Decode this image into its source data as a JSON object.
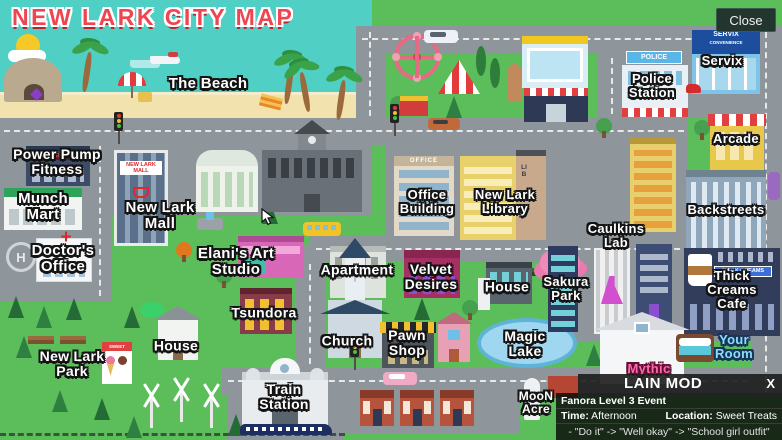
{
  "title": "NEW LARK CITY MAP",
  "close_button": "Close",
  "colors": {
    "water": "#50cfc5",
    "grass": "#5cbe5a",
    "road": "#8e959b",
    "sand": "#f2e2ad",
    "title_red": "#ef4550",
    "your_room_blue": "#8fdcf8",
    "mythic_pink": "#ff67b0",
    "panel_bg": "rgba(12,12,12,0.84)"
  },
  "locations": [
    {
      "id": "the-beach",
      "label": "The Beach"
    },
    {
      "id": "power-pump-fitness",
      "label": "Power Pump\nFitness"
    },
    {
      "id": "munch-mart",
      "label": "Munch\nMart"
    },
    {
      "id": "doctors-office",
      "label": "Doctor's\nOffice"
    },
    {
      "id": "new-lark-mall",
      "label": "New Lark\nMall"
    },
    {
      "id": "elanis-art-studio",
      "label": "Elani's Art\nStudio"
    },
    {
      "id": "tsundora",
      "label": "Tsundora"
    },
    {
      "id": "house-west",
      "label": "House"
    },
    {
      "id": "new-lark-park",
      "label": "New Lark\nPark"
    },
    {
      "id": "apartment",
      "label": "Apartment"
    },
    {
      "id": "velvet-desires",
      "label": "Velvet\nDesires"
    },
    {
      "id": "church",
      "label": "Church"
    },
    {
      "id": "pawn-shop",
      "label": "Pawn\nShop"
    },
    {
      "id": "train-station",
      "label": "Train\nStation"
    },
    {
      "id": "office-building",
      "label": "Office\nBuilding"
    },
    {
      "id": "new-lark-library",
      "label": "New Lark\nLibrary"
    },
    {
      "id": "caulkins-lab",
      "label": "Caulkins\nLab"
    },
    {
      "id": "house-east",
      "label": "House"
    },
    {
      "id": "sakura-park",
      "label": "Sakura\nPark"
    },
    {
      "id": "magic-lake",
      "label": "Magic\nLake"
    },
    {
      "id": "police-station",
      "label": "Police\nStation"
    },
    {
      "id": "servix",
      "label": "Servix"
    },
    {
      "id": "arcade",
      "label": "Arcade"
    },
    {
      "id": "backstreets",
      "label": "Backstreets"
    },
    {
      "id": "thick-creams-cafe",
      "label": "Thick Creams\nCafe"
    },
    {
      "id": "your-room",
      "label": "Your\nRoom"
    },
    {
      "id": "mythic",
      "label": "Mythic"
    },
    {
      "id": "moon-acre",
      "label": "MooN\nAcre"
    }
  ],
  "signs": {
    "mall": "NEW LARK\nMALL",
    "power_pump": "POWER PUMP",
    "police": "POLICE",
    "servix": "SERVIX",
    "servix_sub": "CONVENIENCE",
    "office": "OFFICE",
    "library": "LIB",
    "thick_creams": "THICK CREAMS",
    "sweet_treats": "SWEET TREATS",
    "helipad": "H"
  },
  "mod_panel": {
    "title": "LAIN MOD",
    "close": "X",
    "event": "Fanora Level 3 Event",
    "time_label": "Time:",
    "time_value": "Afternoon",
    "location_label": "Location:",
    "location_value": "Sweet Treats",
    "dialog": "- \"Do it\" -> \"Well okay\" -> \"School girl outfit\""
  }
}
